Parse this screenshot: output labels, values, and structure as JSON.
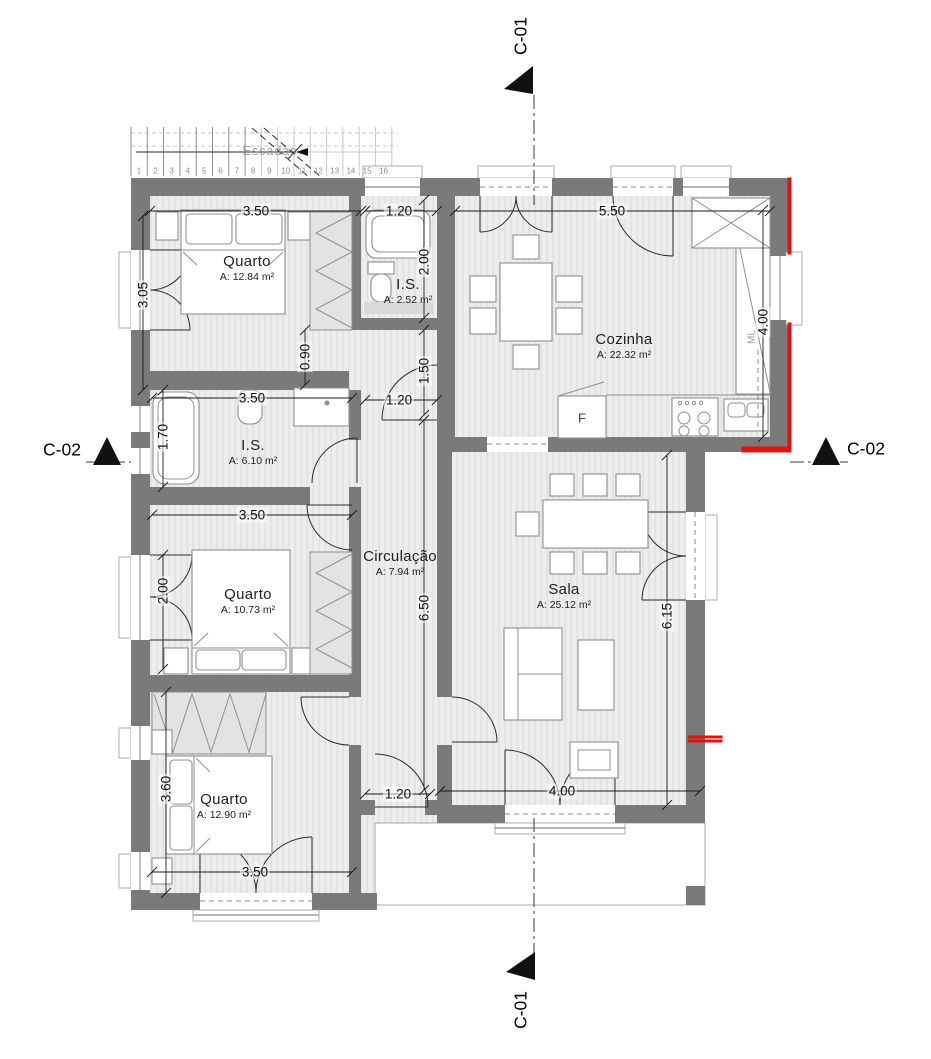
{
  "drawing_title": "Floor plan",
  "colors": {
    "wall": "#7a7a7a",
    "floor": "#ededed",
    "floor_stripe": "#dfdfdf",
    "accent_red": "#e31212",
    "furniture_stroke": "#8f8f8f",
    "line": "#1a1a1a"
  },
  "rooms": [
    {
      "name": "Quarto",
      "area": "A: 12.84 m²",
      "x": 247,
      "y": 268
    },
    {
      "name": "I.S.",
      "area": "A: 2.52 m²",
      "x": 408,
      "y": 291
    },
    {
      "name": "Cozinha",
      "area": "A: 22.32 m²",
      "x": 624,
      "y": 346
    },
    {
      "name": "I.S.",
      "area": "A: 6.10 m²",
      "x": 253,
      "y": 452
    },
    {
      "name": "Quarto",
      "area": "A: 10.73 m²",
      "x": 248,
      "y": 601
    },
    {
      "name": "Circulação",
      "area": "A: 7.94 m²",
      "x": 400,
      "y": 563
    },
    {
      "name": "Sala",
      "area": "A: 25.12 m²",
      "x": 564,
      "y": 596
    },
    {
      "name": "Quarto",
      "area": "A: 12.90 m²",
      "x": 224,
      "y": 806
    }
  ],
  "dimensions": [
    {
      "text": "3.50",
      "x": 256,
      "y": 211,
      "rot": 0
    },
    {
      "text": "1.20",
      "x": 399,
      "y": 211,
      "rot": 0
    },
    {
      "text": "5.50",
      "x": 612,
      "y": 211,
      "rot": 0
    },
    {
      "text": "3.05",
      "x": 143,
      "y": 295,
      "rot": -90
    },
    {
      "text": "2.00",
      "x": 424,
      "y": 262,
      "rot": -90
    },
    {
      "text": "4.00",
      "x": 763,
      "y": 322,
      "rot": -90
    },
    {
      "text": "0.90",
      "x": 305,
      "y": 357,
      "rot": -90
    },
    {
      "text": "1.50",
      "x": 424,
      "y": 371,
      "rot": -90
    },
    {
      "text": "3.50",
      "x": 252,
      "y": 398,
      "rot": 0
    },
    {
      "text": "1.20",
      "x": 399,
      "y": 400,
      "rot": 0
    },
    {
      "text": "1.70",
      "x": 163,
      "y": 437,
      "rot": -90
    },
    {
      "text": "3.50",
      "x": 252,
      "y": 515,
      "rot": 0
    },
    {
      "text": "2.00",
      "x": 163,
      "y": 591,
      "rot": -90
    },
    {
      "text": "6.50",
      "x": 424,
      "y": 608,
      "rot": -90
    },
    {
      "text": "6.15",
      "x": 667,
      "y": 616,
      "rot": -90
    },
    {
      "text": "3.60",
      "x": 166,
      "y": 789,
      "rot": -90
    },
    {
      "text": "1.20",
      "x": 398,
      "y": 794,
      "rot": 0
    },
    {
      "text": "4.00",
      "x": 562,
      "y": 791,
      "rot": 0
    },
    {
      "text": "3.50",
      "x": 255,
      "y": 872,
      "rot": 0
    }
  ],
  "markers": {
    "c01_top": {
      "label": "C-01"
    },
    "c01_bottom": {
      "label": "C-01"
    },
    "c02_left": {
      "label": "C-02"
    },
    "c02_right": {
      "label": "C-02"
    }
  },
  "stairs": {
    "label": "Escadas",
    "numbers": [
      "1",
      "2",
      "3",
      "4",
      "5",
      "6",
      "7",
      "8",
      "9",
      "10",
      "11",
      "12",
      "13",
      "14",
      "15",
      "16"
    ]
  },
  "kitchen": {
    "fridge_label": "F",
    "washer_label": "ML"
  }
}
